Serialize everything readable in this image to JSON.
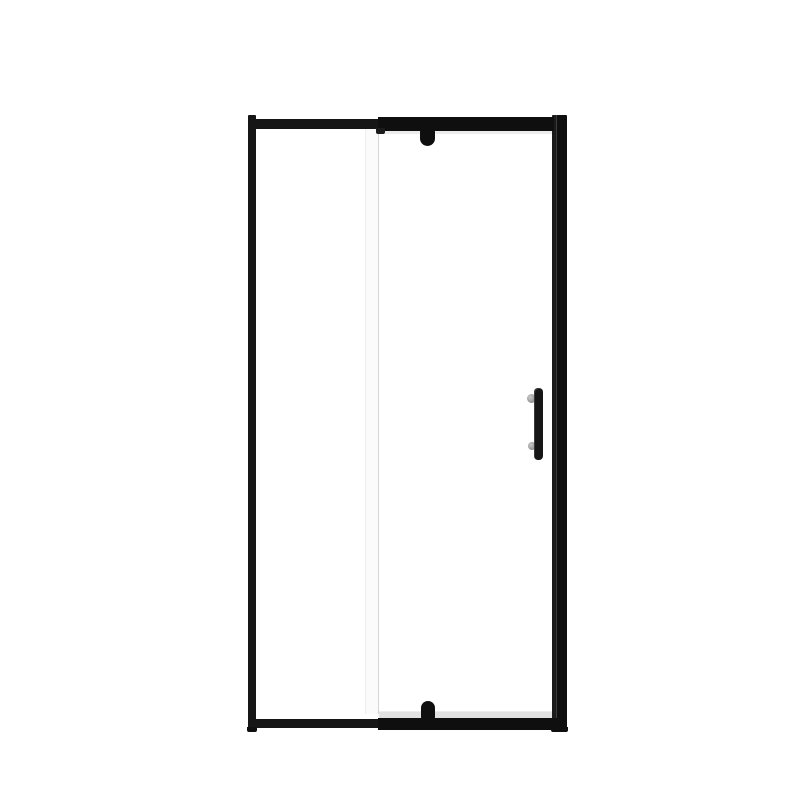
{
  "scene": {
    "description": "Product photo of a framed pivot shower door: matte black aluminum frame, clear glass, centered on a plain white background",
    "object": "pivot shower door",
    "parts": {
      "left_jamb": "left vertical frame jamb",
      "right_jamb": "right vertical frame jamb with wall profile seam",
      "top_rail": "top horizontal frame rail with step at fixed panel",
      "bottom_rail": "bottom horizontal frame rail",
      "top_pivot": "top pivot hinge knob",
      "bottom_pivot": "bottom pivot hinge knob",
      "fixed_panel_edge": "vertical white edge strip of fixed glass panel",
      "door_handle": "vertical black handle bar with two gray mounts",
      "glass_reflections": "light gray reflection strips at top and bottom of door glass"
    }
  },
  "colors": {
    "background": "#ffffff",
    "frame": "#161616",
    "frameDark": "#0f0f0f",
    "frameSoft": "#1b1b1b",
    "seam": "#3a3a3a",
    "glassHighlight": "#ececec",
    "glassBottom": "#e2e2e2",
    "panelEdge": "#fbfbfb",
    "panelEdgeLight": "#efefef",
    "panelEdgeDark": "#d4d4d4",
    "mount": "#8f8f8f",
    "mountLight": "#c9c9c9"
  }
}
